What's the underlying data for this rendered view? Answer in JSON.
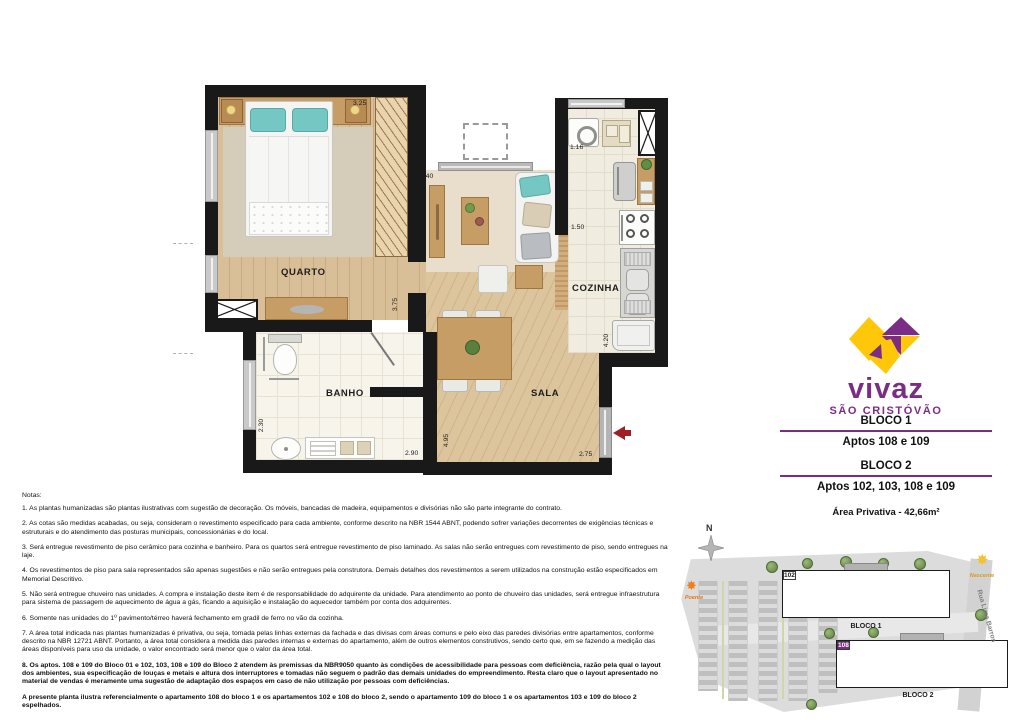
{
  "brand": {
    "name": "vivaz",
    "location": "SÃO CRISTÓVÃO",
    "purple": "#7b2c85",
    "yellow": "#ffc709"
  },
  "info": {
    "bloco1_title": "BLOCO 1",
    "bloco1_aptos": "Aptos 108 e 109",
    "bloco2_title": "BLOCO 2",
    "bloco2_aptos": "Aptos 102, 103, 108 e 109",
    "area": "Área Privativa - 42,66m²"
  },
  "plan": {
    "rooms": {
      "quarto": "QUARTO",
      "banho": "BANHO",
      "sala": "SALA",
      "cozinha": "COZINHA"
    },
    "dims": {
      "d325": "3.25",
      "d240": "2.40",
      "d116": "1.16",
      "d150": "1.50",
      "d375": "3.75",
      "d420": "4.20",
      "d230": "2.30",
      "d290": "2.90",
      "d495": "4.95",
      "d275": "2.75"
    },
    "entry_arrow_color": "#9e1f26"
  },
  "notes": {
    "heading": "Notas:",
    "items": [
      {
        "text": "1. As plantas humanizadas são plantas ilustrativas com sugestão de decoração. Os móveis, bancadas de madeira, equipamentos e divisórias não são parte integrante do contrato.",
        "bold": false
      },
      {
        "text": "2. As cotas são medidas acabadas, ou seja, consideram o revestimento especificado para cada ambiente, conforme descrito na NBR 1544 ABNT, podendo sofrer variações decorrentes de exigências técnicas e estruturais e do atendimento das posturas municipais, concessionárias e do local.",
        "bold": false
      },
      {
        "text": "3. Será entregue revestimento de piso cerâmico para cozinha e banheiro. Para os quartos será entregue revestimento de piso laminado. As salas não serão entregues com revestimento de piso, sendo entregues na laje.",
        "bold": false
      },
      {
        "text": "4. Os revestimentos de piso para sala representados são apenas sugestões e não serão entregues pela construtora. Demais detalhes dos revestimentos a serem utilizados na construção estão especificados em Memorial Descritivo.",
        "bold": false
      },
      {
        "text": "5. Não será entregue chuveiro nas unidades. A compra e instalação deste item é de responsabilidade do adquirente da unidade. Para atendimento ao ponto de chuveiro das unidades, será entregue infraestrutura para sistema de passagem de aquecimento de água a gás, ficando a aquisição e instalação do aquecedor também por conta dos adquirentes.",
        "bold": false
      },
      {
        "text": "6. Somente nas unidades do 1º pavimento/térreo haverá fechamento em gradil de ferro no vão da cozinha.",
        "bold": false
      },
      {
        "text": "7. A área total indicada nas plantas humanizadas é privativa, ou seja, tomada pelas linhas externas da fachada e das divisas com áreas comuns e pelo eixo das paredes divisórias entre apartamentos, conforme descrito na NBR 12721 ABNT. Portanto, a área total considera a medida das paredes internas e externas do apartamento, além de outros elementos construtivos, sendo certo que, em se fazendo a medição das áreas disponíveis para uso da unidade, o valor encontrado será menor que o valor da área total.",
        "bold": false
      },
      {
        "text": "8. Os aptos. 108 e 109 do Bloco 01 e 102, 103, 108 e 109 do Bloco 2 atendem às premissas da NBR9050 quanto às condições de acessibilidade para pessoas com deficiência, razão pela qual o layout dos ambientes, sua especificação de louças e metais e altura dos interruptores e tomadas não seguem o padrão das demais unidades do empreendimento. Resta claro que o layout apresentado no material de vendas é meramente uma sugestão de adaptação dos espaços em caso de não utilização por pessoas com deficiências.",
        "bold": true
      },
      {
        "text": "A presente planta ilustra referencialmente o apartamento 108 do bloco 1 e os apartamentos 102 e 108 do bloco 2, sendo o apartamento 109 do bloco 1 e os apartamentos 103 e 109 do bloco 2 espelhados.",
        "bold": true
      }
    ]
  },
  "siteplan": {
    "north": "N",
    "poente": "Poente",
    "nascente": "Nascente",
    "street": "Rua Lima Barros",
    "unit_colors": {
      "referencial": "#7d2a86",
      "espelhado": "#c9a3cf"
    },
    "bloco1": {
      "label": "BLOCO 1",
      "rows": [
        [
          {
            "n": "108",
            "c": "dark"
          },
          {
            "n": "107"
          },
          {
            "n": "106"
          },
          {
            "n": "105"
          },
          {
            "n": "104"
          },
          {
            "n": "103"
          }
        ],
        [
          {
            "n": "109",
            "c": "light"
          },
          {
            "n": "110"
          },
          {
            "core": true
          },
          {
            "n": "101"
          },
          {
            "n": "102"
          }
        ]
      ]
    },
    "bloco2": {
      "label": "BLOCO 2",
      "rows": [
        [
          {
            "n": "102",
            "c": "dark"
          },
          {
            "n": "101"
          },
          {
            "core": true
          },
          {
            "n": "110"
          },
          {
            "n": "109",
            "c": "light"
          }
        ],
        [
          {
            "n": "103",
            "c": "light"
          },
          {
            "n": "104"
          },
          {
            "n": "105"
          },
          {
            "n": "106"
          },
          {
            "n": "107"
          },
          {
            "n": "108",
            "c": "dark"
          }
        ]
      ]
    }
  }
}
